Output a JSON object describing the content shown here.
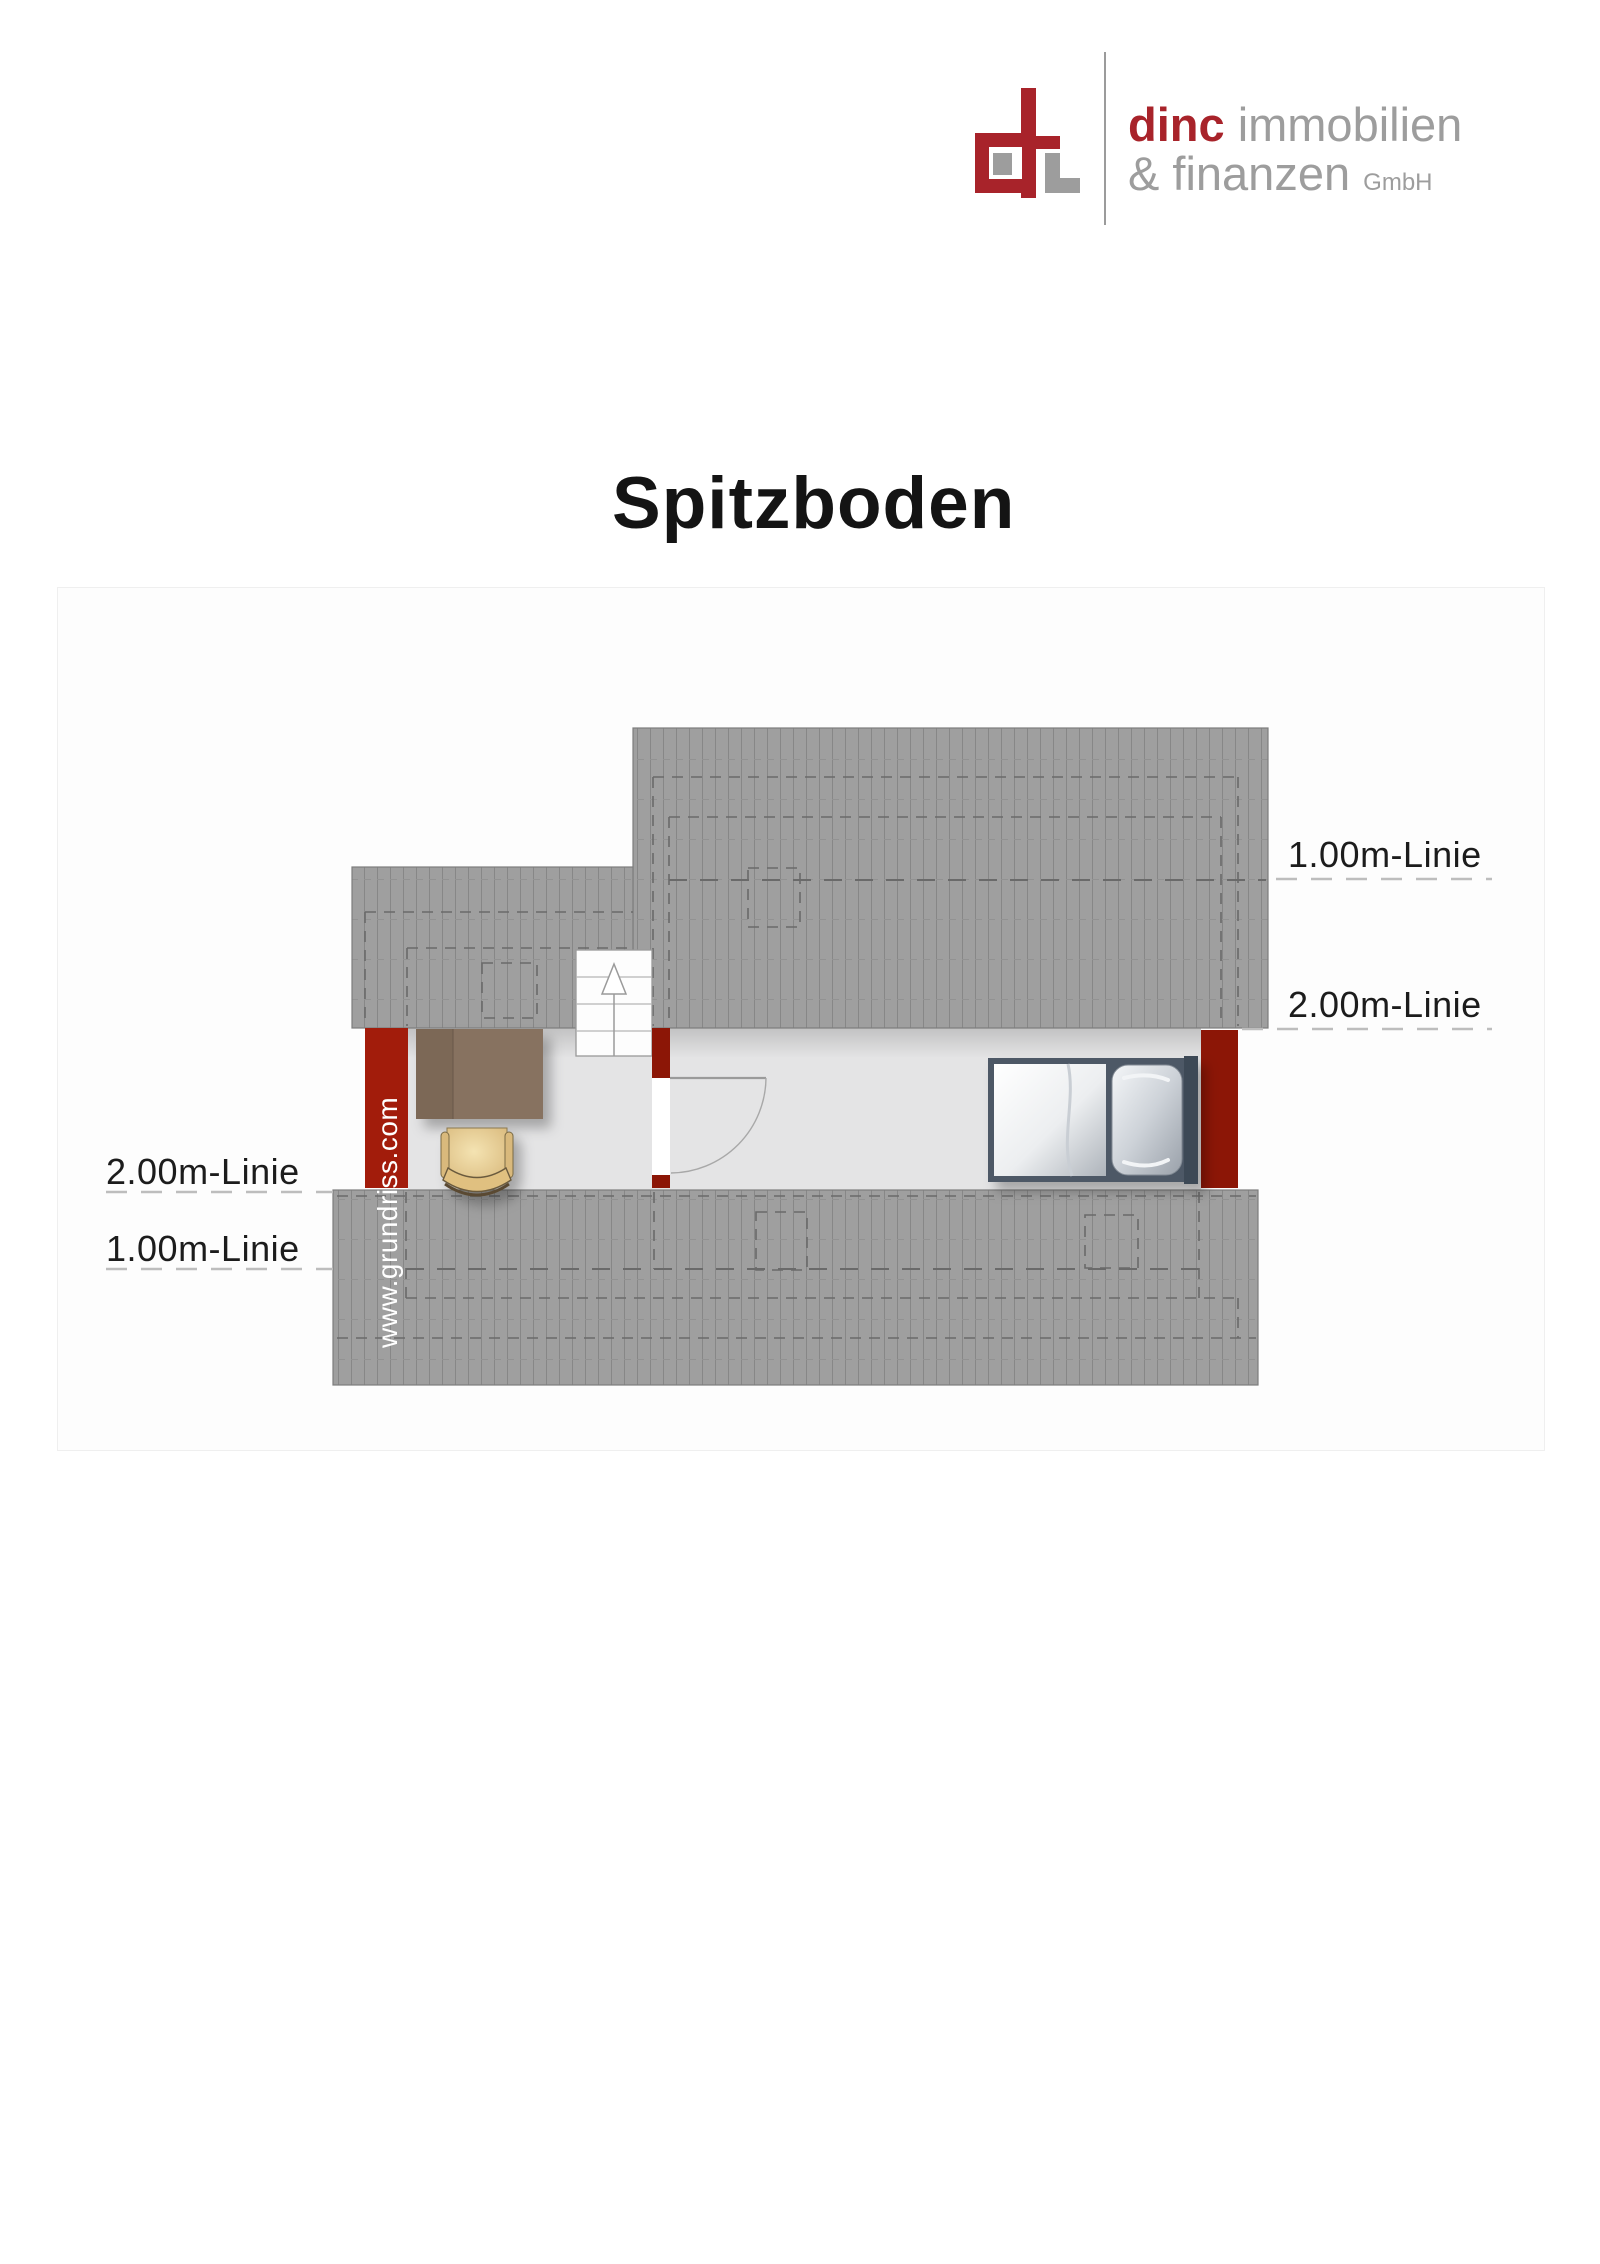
{
  "header": {
    "logo": {
      "word_red": "dinc",
      "word_gray": "immobilien",
      "line2_gray": "& finanzen",
      "suffix": "GmbH",
      "colors": {
        "logo_red": "#a8232a",
        "logo_gray": "#9d9d9d"
      }
    }
  },
  "page": {
    "title": "Spitzboden"
  },
  "plan": {
    "watermark": "www.grundriss.com",
    "height_lines": {
      "right": [
        {
          "label": "1.00m-Linie"
        },
        {
          "label": "2.00m-Linie"
        }
      ],
      "left": [
        {
          "label": "2.00m-Linie"
        },
        {
          "label": "1.00m-Linie"
        }
      ]
    },
    "colors": {
      "wall_red": "#8c1606",
      "watermark_band_red": "#a21c0b",
      "roof_gray": "#9f9f9f",
      "roof_hatch_line": "#878787",
      "floor_gray": "#e4e4e5",
      "dash_dark": "#6a6a6a",
      "dash_light": "#bdbdbd"
    },
    "elements": [
      "roof-hatched-areas",
      "staircase-up-arrow",
      "door-swing",
      "desk",
      "chair",
      "bed-with-pillow"
    ]
  }
}
